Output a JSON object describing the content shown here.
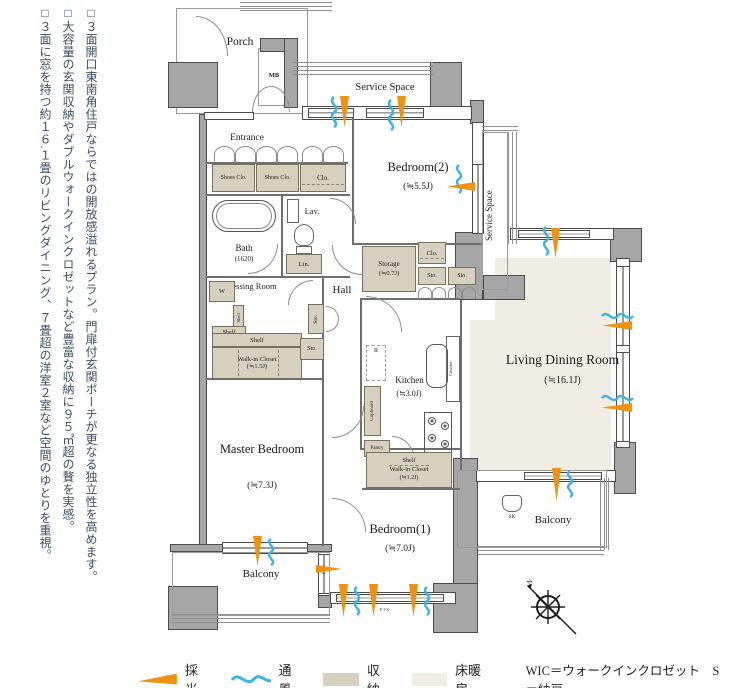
{
  "side_text": {
    "p1": "□３面開口東南角住戸ならではの開放感溢れるプラン。門扉付玄関ポーチが更なる独立性を高めます。",
    "p2": "□大容量の玄関収納やダブルウォークインクロゼットなど豊富な収納に９５㎡超の贅を実感。",
    "p3": "□３面に窓を持つ約１６.１畳のリビングダイニング、７畳超の洋室２室など空間のゆとりを重視。"
  },
  "plan": {
    "porch": "Porch",
    "mb": "MB",
    "service_space": "Service Space",
    "entrance": "Entrance",
    "shoes_clo": "Shoes Clo.",
    "clo": "Clo.",
    "bath": "Bath",
    "bath_size": "(1620)",
    "lav": "Lav.",
    "lin": "Lin.",
    "dressing_room": "Dressing Room",
    "washer": "W",
    "shelf": "Shelf",
    "wic": "Walk-in Closet",
    "wic1_size": "(≒1.5J)",
    "wic2_size": "(≒1.2J)",
    "sto": "Sto.",
    "hall": "Hall",
    "bedroom2": "Bedroom(2)",
    "bedroom2_size": "(≒5.5J)",
    "storage": "Storage",
    "storage_size": "(≒0.7J)",
    "ldk": "Living Dining Room",
    "ldk_size": "(≒16.1J)",
    "kitchen": "Kitchen",
    "kitchen_size": "(≒3.0J)",
    "fridge": "R",
    "cupboard": "Cupboard",
    "pantry": "Pantry",
    "counter": "Counter",
    "master": "Master Bedroom",
    "master_size": "(≒7.3J)",
    "bedroom1": "Bedroom(1)",
    "bedroom1_size": "(≒7.0J)",
    "balcony": "Balcony",
    "sk": "SK",
    "fix": "FIX",
    "compass_n": "N"
  },
  "legend": {
    "daylight": "採光",
    "ventilation": "通風",
    "storage": "収納",
    "floor_heating": "床暖房",
    "notes": "WIC＝ウォークインクロゼット　S＝納戸"
  },
  "colors": {
    "wall": "#a6a6a6",
    "wall_line": "#4c4c4c",
    "storage_fill": "#d7d0bf",
    "floor_heating_fill": "#f0ede4",
    "daylight": "#f0920f",
    "ventilation": "#3ab4e8",
    "side_text": "#3d4f63"
  }
}
